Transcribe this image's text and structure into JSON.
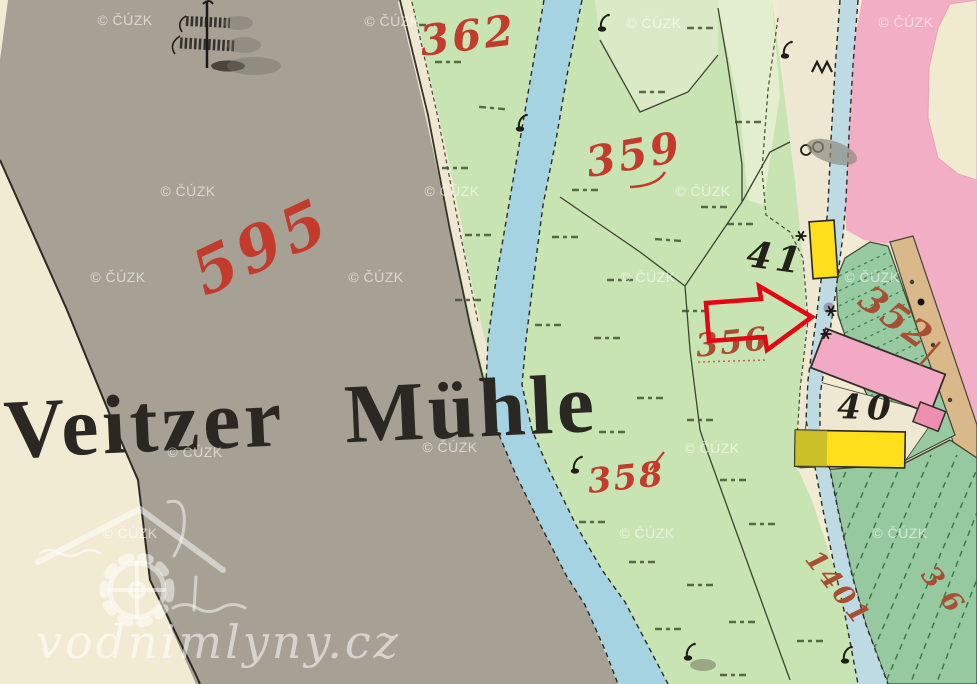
{
  "map": {
    "place_label": "Veitzer Mühle",
    "parcel_labels": {
      "p595": "595",
      "p362": "362",
      "p359": "359",
      "p358": "358",
      "p356": "356",
      "p352": "352",
      "p1401": "1401",
      "p36": "36"
    },
    "building_labels": {
      "b41": "41",
      "b40": "40"
    },
    "colors": {
      "paper": "#f2ebd3",
      "gray": "#a6a095",
      "meadow": "#c8e4b2",
      "meadow_light1": "#daeac6",
      "meadow_light2": "#e2eecd",
      "strip": "#eee8d2",
      "stream": "#a6d3e2",
      "race": "#bedae3",
      "pink": "#f2aec4",
      "blob": "#f0ebce",
      "path_tan": "#d9b98a",
      "garden": "#97caa1",
      "orchard": "#96c9a0",
      "yellow": "#ffdf1b",
      "mill_pink": "#f2a9c4",
      "annex_pink": "#ee8fb2",
      "red_label": "#c23b2c",
      "red_label_brown": "#a84e32",
      "black_label": "#24211a",
      "arrow": "#e30613"
    }
  },
  "watermark": {
    "text": "© ČÚZK"
  },
  "logo": {
    "text": "vodnimlyny.cz"
  }
}
